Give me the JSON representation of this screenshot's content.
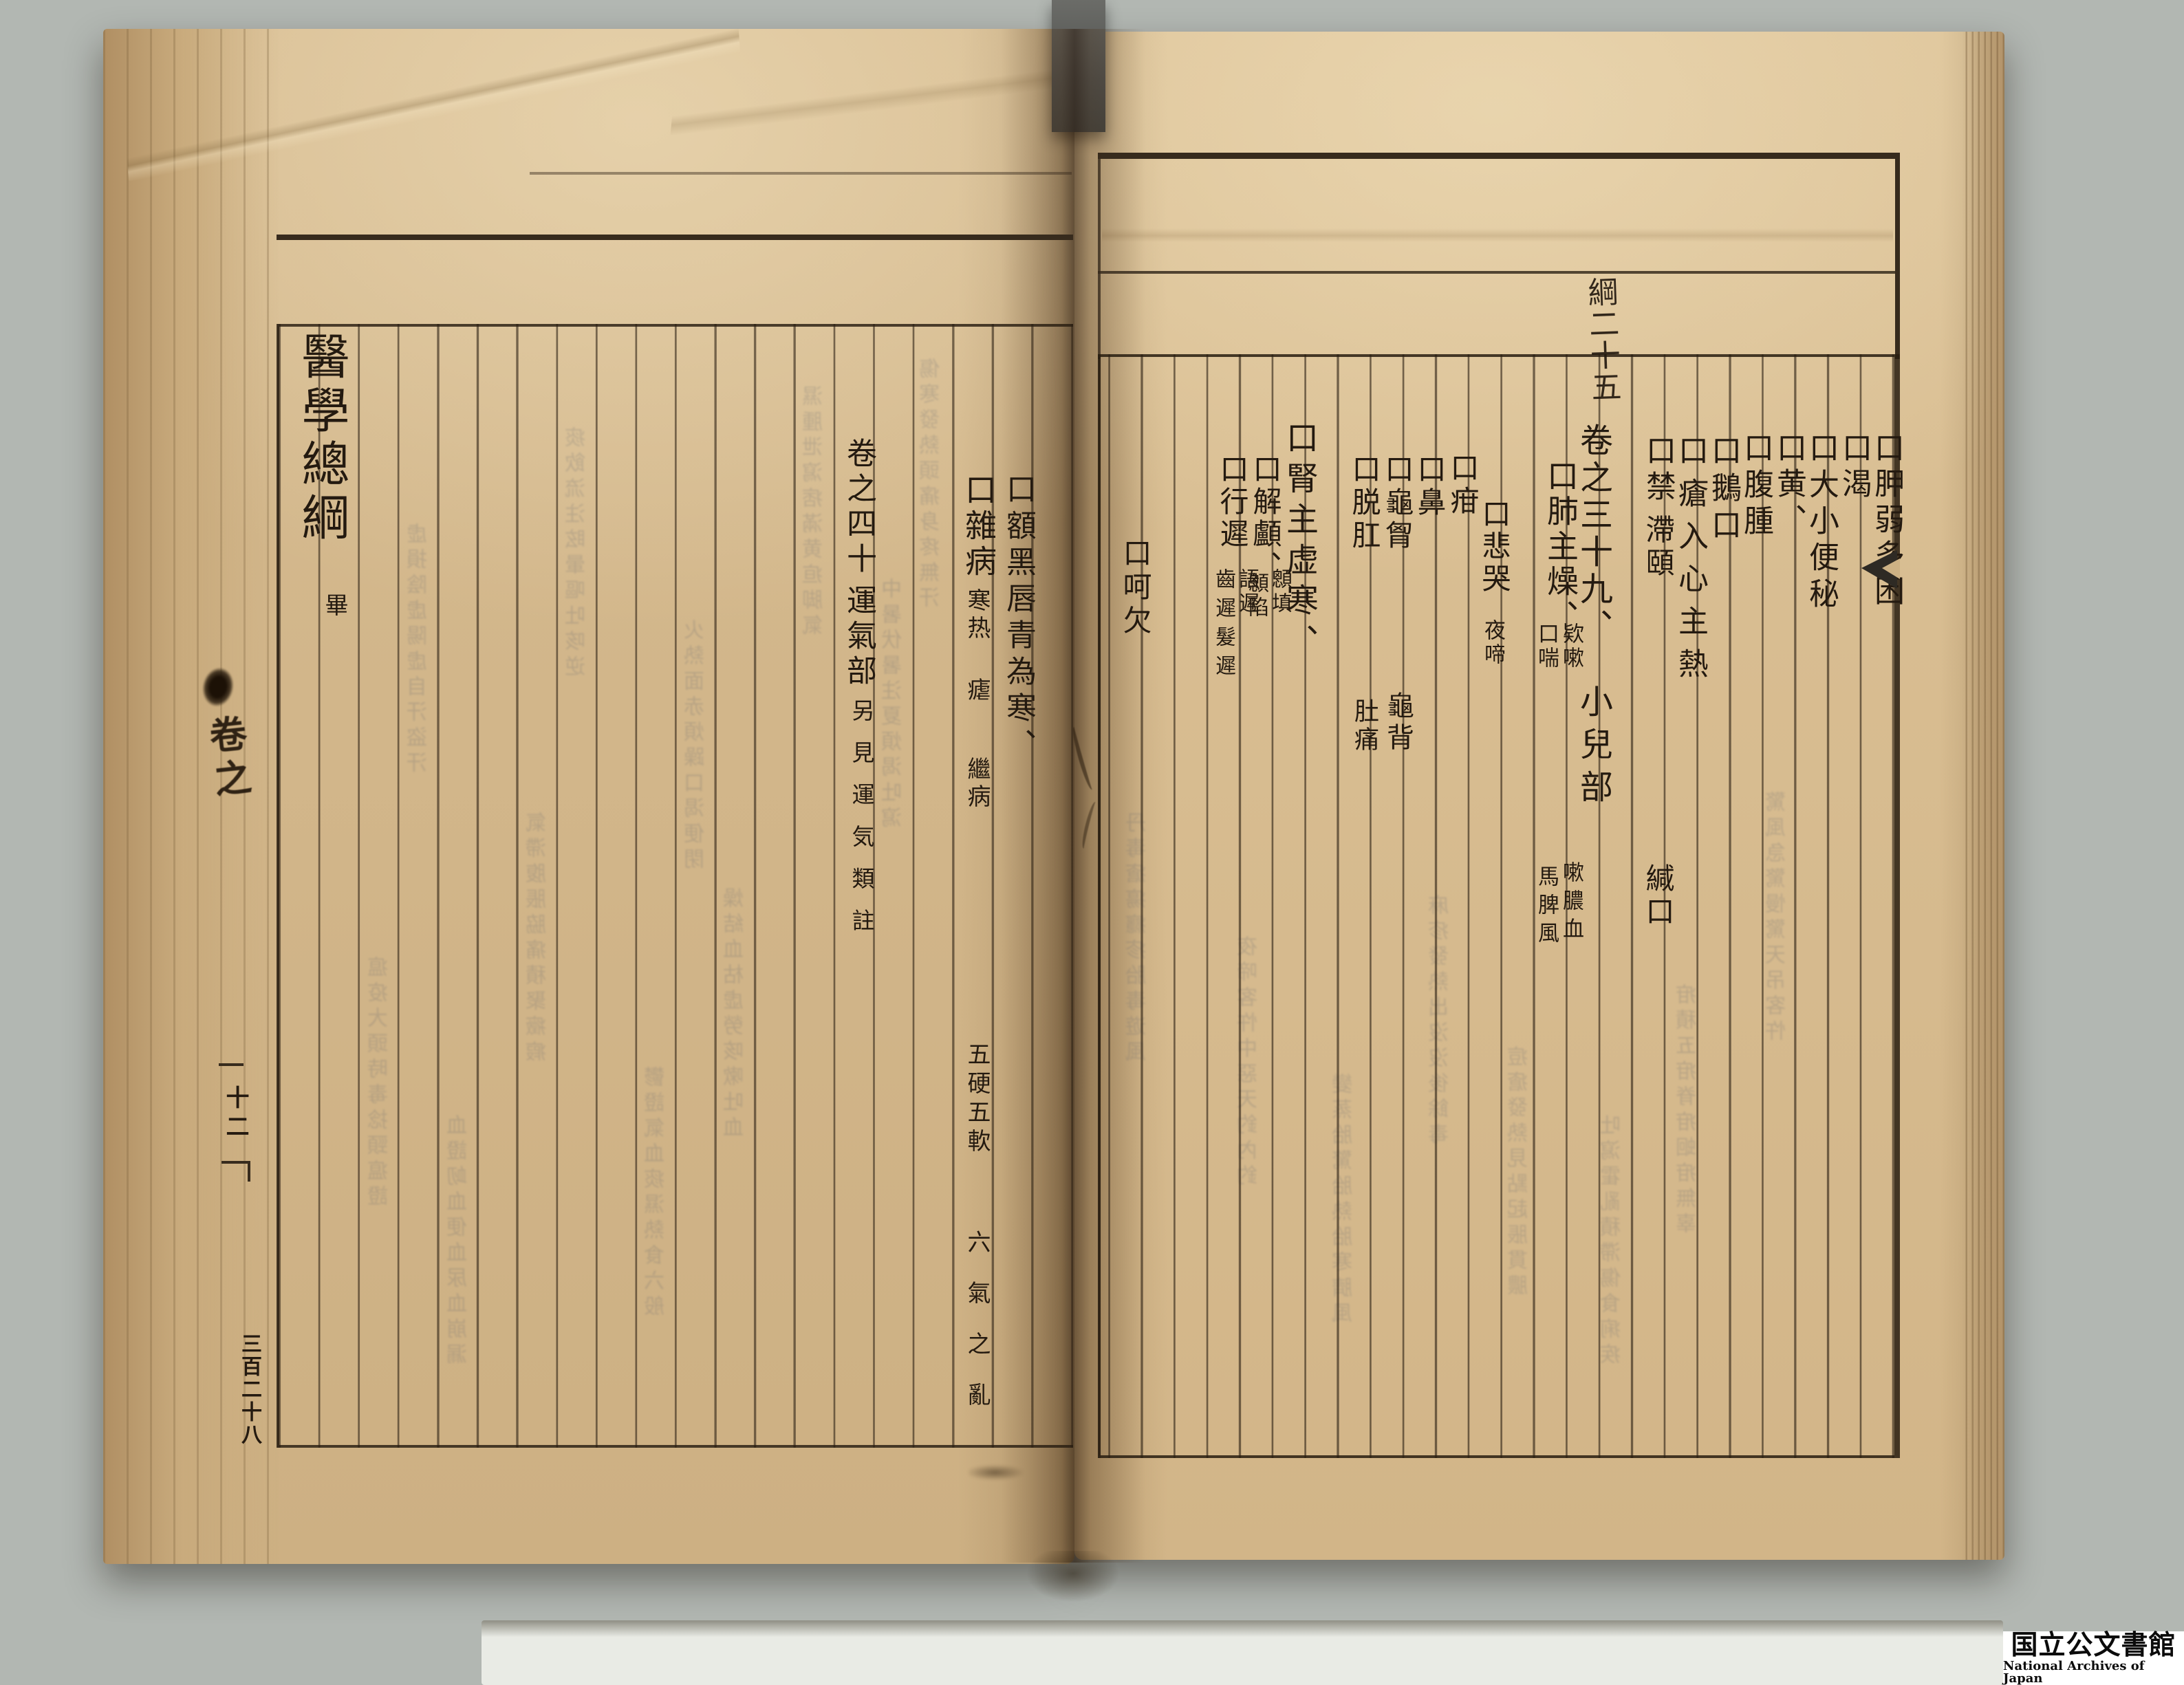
{
  "colors": {
    "bg": "#b2b7b2",
    "surface": "#e9ebe5",
    "paper_left": "#d6bb90",
    "paper_right": "#dcc297",
    "ink": "#241a10",
    "line": "#372b1d",
    "bleed": "#5c616c",
    "strap": "#56575a",
    "watermark_bg": "#ffffff",
    "watermark_ink": "#0b0b0b"
  },
  "right_page": {
    "header_note": "綱二十五",
    "columns": [
      {
        "main": "口胛弱多困"
      },
      {
        "main": "口渴"
      },
      {
        "main": "口大小便秘"
      },
      {
        "main": "口黄、"
      },
      {
        "main": "口腹腫"
      },
      {
        "main": "口鵝口"
      },
      {
        "main": "口瘡入心主熱"
      },
      {
        "main": "口禁",
        "mid": "滯頤",
        "low": "緘口"
      },
      {
        "main": "卷之三十九、",
        "low": "小兒部"
      },
      {
        "main": "口肺主燥、",
        "sub_right": "欵嗽",
        "sub_left": "口喘",
        "sub2_right": "嗽膿血",
        "sub2_left": "馬脾風"
      },
      {
        "main": "口悲哭",
        "low": "夜啼"
      },
      {
        "main": "口疳"
      },
      {
        "main": "口鼻"
      },
      {
        "main": "口龜胷",
        "low": "龜背"
      },
      {
        "main": "口脱肛",
        "low": "肚痛"
      },
      {
        "main": "口腎主虚寒、"
      },
      {
        "main": "口解顱、",
        "sub_right": "顖填",
        "sub_left": "顖陷"
      },
      {
        "main": "口行遲",
        "sub_right": "語遲",
        "sub_left": "齒遲髮遲"
      },
      {
        "main": "口呵欠"
      }
    ]
  },
  "left_page": {
    "columns": [
      {
        "main": "口額黑唇青為寒、"
      },
      {
        "main": "口雜病",
        "runs": [
          "寒热",
          "瘧",
          "繼病",
          "五硬五軟",
          "六氣之亂"
        ]
      },
      {
        "main": "卷之四十",
        "main2": "運氣部",
        "note": "另見運気類註"
      },
      {
        "main": "醫學總綱",
        "end_mark": "畢"
      }
    ],
    "fore_edge": {
      "handwritten": "卷之",
      "folio": "十二",
      "page_number": "三百二十八"
    }
  },
  "bleed": {
    "left": [
      "傷寒發熱頭痛身疼無汗",
      "中暑伏暑注夏煩渴吐瀉",
      "濕腫泄瀉痞滿黄疸脚氣",
      "燥結血枯虚勞咳嗽吐血",
      "火熱面赤煩躁口渴便閉",
      "鬱證氣血痰濕熱食六般",
      "痰飲流注眩暈嘔吐咳逆",
      "氣滯腹脹脇痛積聚癥瘕",
      "血證衂血便血尿血崩漏",
      "虚損陰虚陽虚自汗盜汗",
      "瘟疫大頭時毒捻頸瘟證"
    ],
    "right": [
      "驚風急驚慢驚天吊客忤",
      "疳積五疳脊疳蛔疳無辜",
      "吐瀉霍亂積滯傷食痢疾",
      "痘瘡發熱見點起脹貫膿",
      "麻疹發熱出沒沒後餘毒",
      "變蒸胎驚胎熱胎寒臍風",
      "夜啼客忤中惡天釣內釣",
      "丹毒瘡瘍癮疹胎毒遊風"
    ]
  },
  "watermark": {
    "jp": "国立公文書館",
    "en": "National Archives of Japan"
  }
}
